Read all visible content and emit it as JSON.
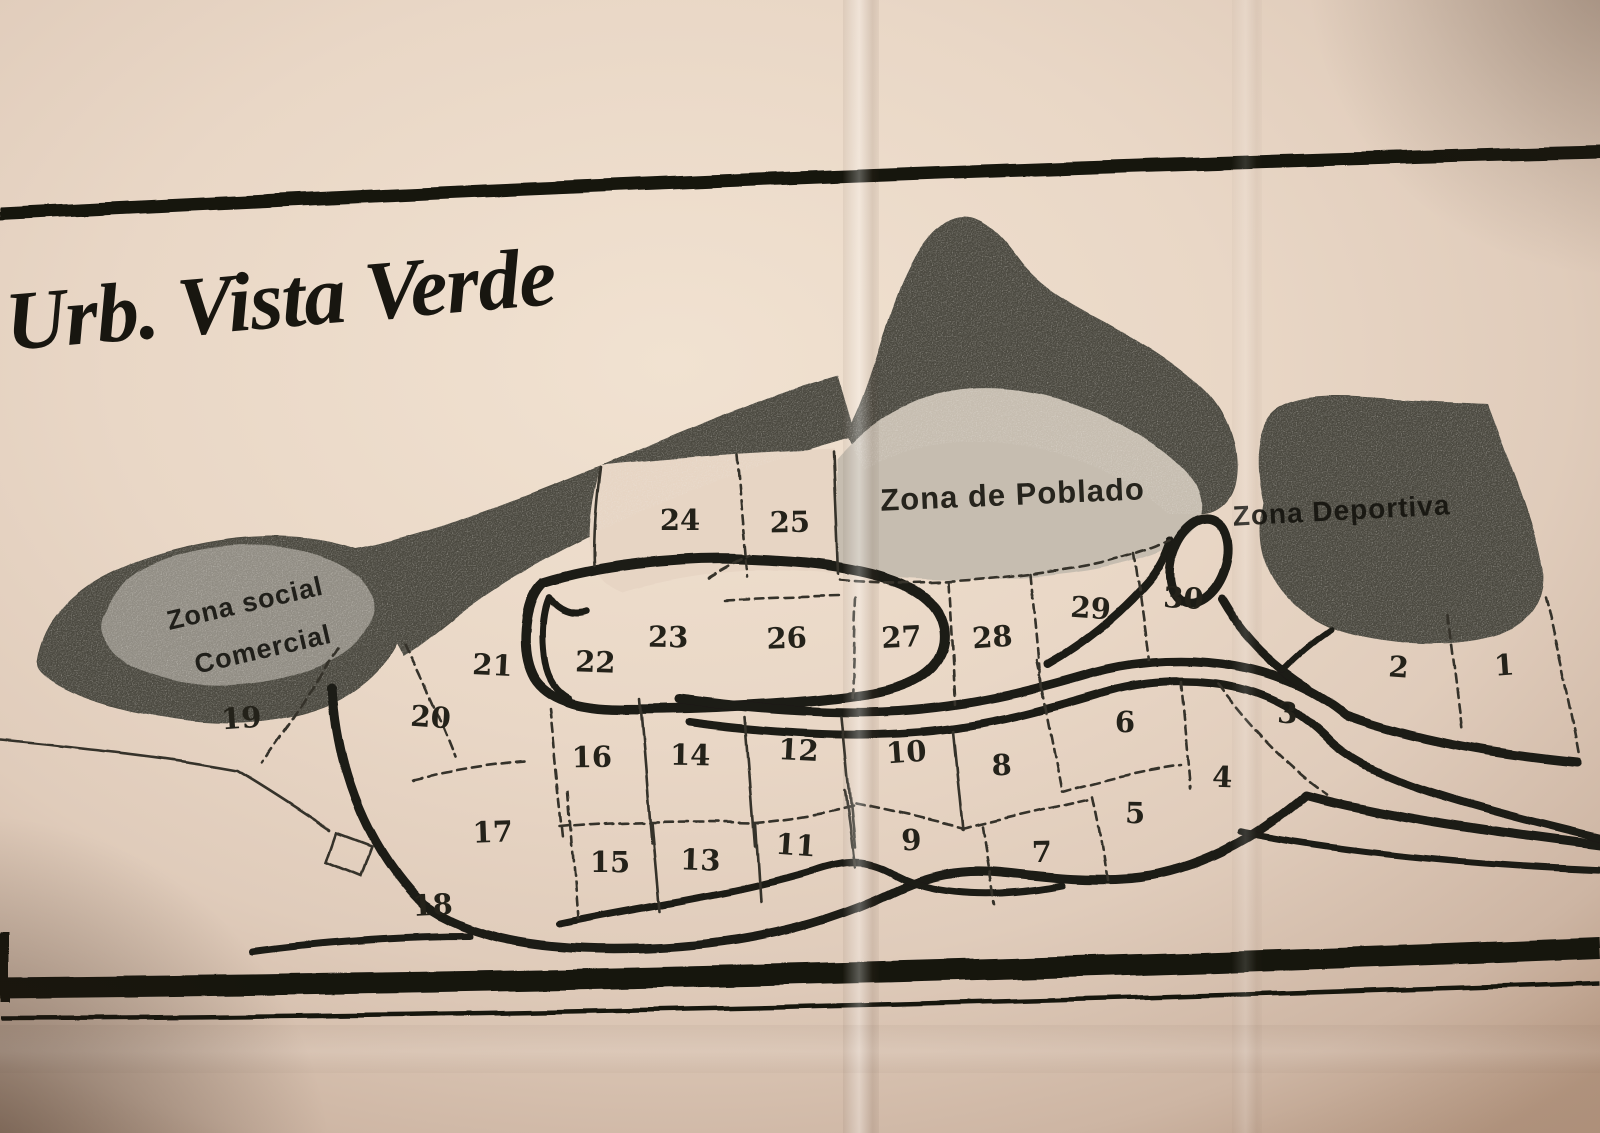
{
  "map": {
    "title": "Urb. Vista Verde",
    "zones": [
      {
        "name": "zona-social-comercial",
        "label_lines": [
          "Zona social",
          "Comercial"
        ]
      },
      {
        "name": "zona-de-poblado",
        "label": "Zona de Poblado"
      },
      {
        "name": "zona-deportiva",
        "label": "Zona Deportiva"
      }
    ],
    "lots": [
      {
        "label": "1",
        "x": 1505,
        "y": 675
      },
      {
        "label": "2",
        "x": 1398,
        "y": 677
      },
      {
        "label": "3",
        "x": 1287,
        "y": 723
      },
      {
        "label": "4",
        "x": 1222,
        "y": 787
      },
      {
        "label": "5",
        "x": 1135,
        "y": 823
      },
      {
        "label": "6",
        "x": 1125,
        "y": 732
      },
      {
        "label": "7",
        "x": 1042,
        "y": 862
      },
      {
        "label": "8",
        "x": 1002,
        "y": 775
      },
      {
        "label": "9",
        "x": 912,
        "y": 850
      },
      {
        "label": "10",
        "x": 907,
        "y": 762
      },
      {
        "label": "11",
        "x": 795,
        "y": 855
      },
      {
        "label": "12",
        "x": 798,
        "y": 760
      },
      {
        "label": "13",
        "x": 700,
        "y": 870
      },
      {
        "label": "14",
        "x": 690,
        "y": 765
      },
      {
        "label": "15",
        "x": 610,
        "y": 872
      },
      {
        "label": "16",
        "x": 592,
        "y": 767
      },
      {
        "label": "17",
        "x": 493,
        "y": 842
      },
      {
        "label": "18",
        "x": 433,
        "y": 915
      },
      {
        "label": "19",
        "x": 242,
        "y": 728
      },
      {
        "label": "20",
        "x": 430,
        "y": 727
      },
      {
        "label": "21",
        "x": 492,
        "y": 675
      },
      {
        "label": "22",
        "x": 595,
        "y": 672
      },
      {
        "label": "23",
        "x": 668,
        "y": 647
      },
      {
        "label": "24",
        "x": 680,
        "y": 530
      },
      {
        "label": "25",
        "x": 790,
        "y": 532
      },
      {
        "label": "26",
        "x": 787,
        "y": 648
      },
      {
        "label": "27",
        "x": 902,
        "y": 647
      },
      {
        "label": "28",
        "x": 993,
        "y": 647
      },
      {
        "label": "29",
        "x": 1090,
        "y": 618
      },
      {
        "label": "30",
        "x": 1183,
        "y": 608
      }
    ]
  },
  "colors": {
    "paper": "#e7d5c4",
    "terrain_dark": "#4b4a41",
    "poblado_fill": "#c6bdb0",
    "social_fill": "#918d84",
    "ink": "#1b1a14",
    "label_ink": "#24221a"
  }
}
